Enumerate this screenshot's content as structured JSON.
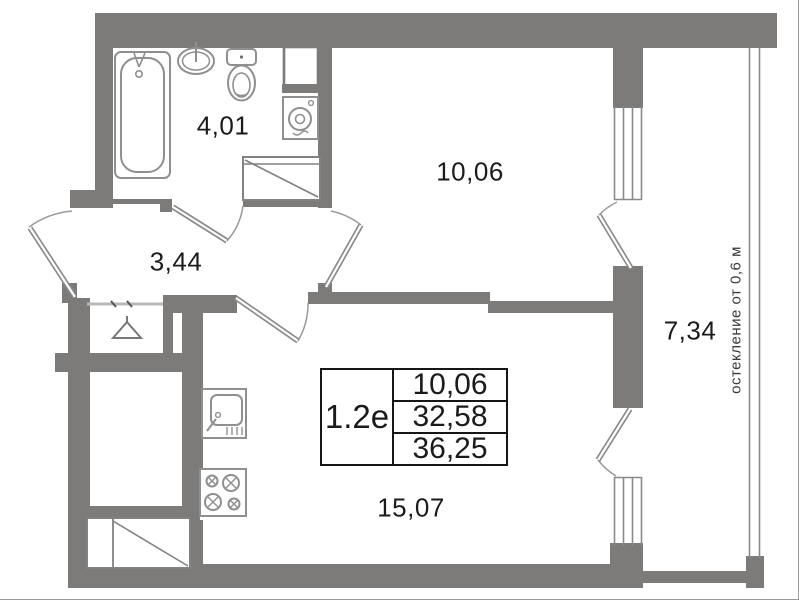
{
  "rooms": {
    "bathroom": {
      "label": "4,01"
    },
    "bedroom": {
      "label": "10,06"
    },
    "hallway": {
      "label": "3,44"
    },
    "balcony": {
      "label": "7,34"
    },
    "kitchen_living": {
      "label": "15,07"
    }
  },
  "table": {
    "unit": "1.2e",
    "rows": [
      "10,06",
      "32,58",
      "36,25"
    ]
  },
  "annotation": {
    "glazing": "остекление от 0,6 м"
  },
  "colors": {
    "wall": "#7d7a7a",
    "fixture_stroke": "#8f8f8f",
    "text": "#1b1b1b"
  },
  "fixtures": [
    "bathtub",
    "wash-basin",
    "toilet",
    "vent-shaft",
    "washing-machine",
    "duct-hatch-bathroom",
    "wardrobe-hanger",
    "kitchen-sink",
    "stove",
    "duct-hatch-kitchen"
  ]
}
